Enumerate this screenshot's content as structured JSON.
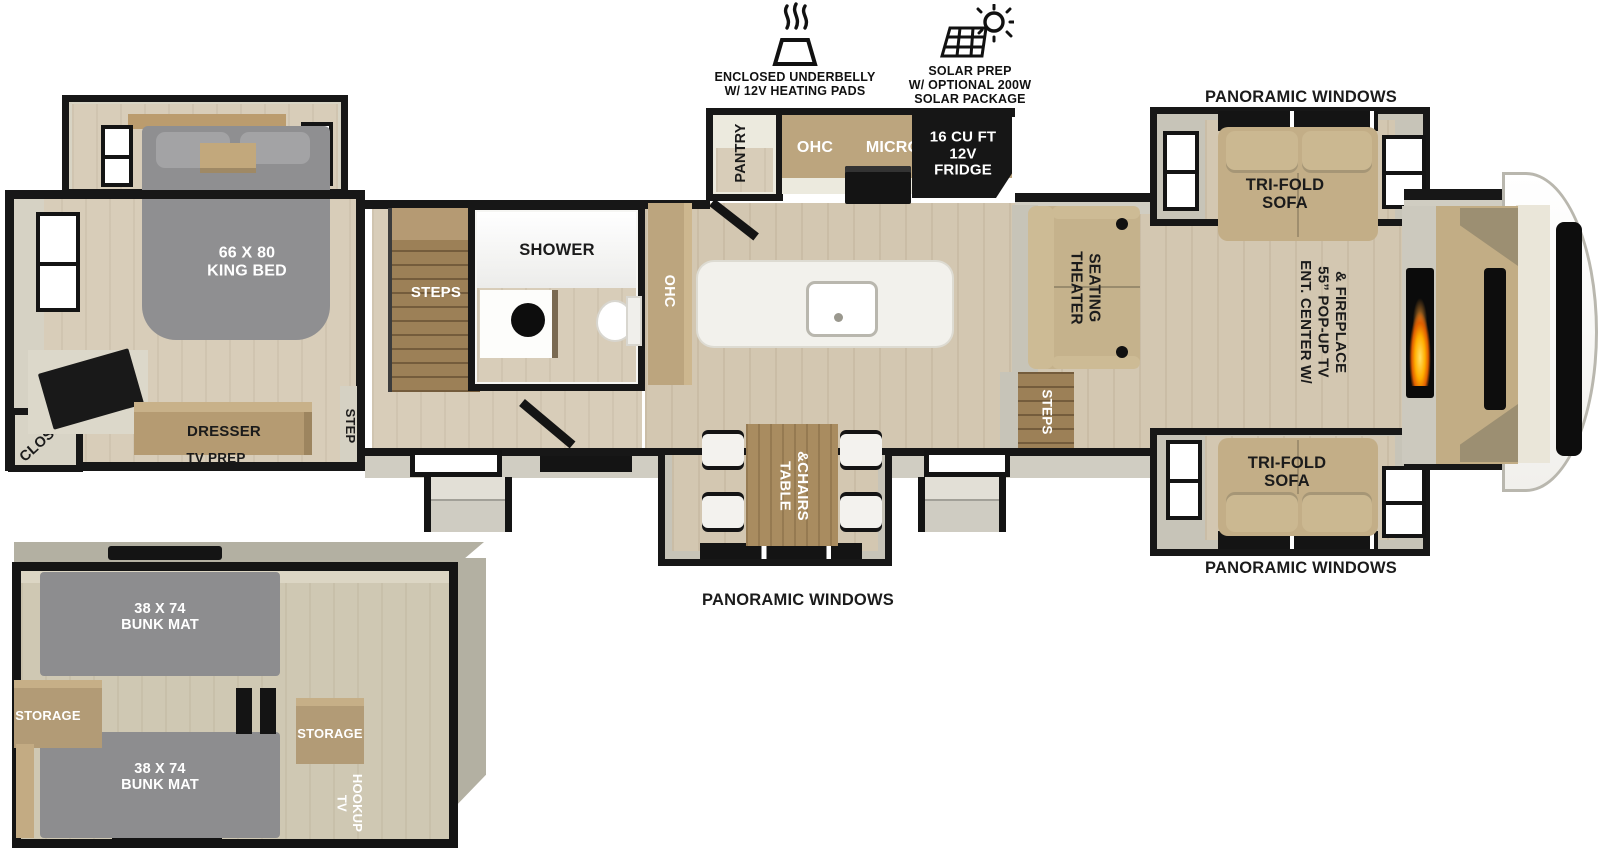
{
  "legend": {
    "underbelly": {
      "line1": "ENCLOSED UNDERBELLY",
      "line2": "W/ 12V HEATING PADS"
    },
    "solar": {
      "line1": "SOLAR PREP",
      "line2": "W/ OPTIONAL 200W",
      "line3": "SOLAR PACKAGE"
    }
  },
  "labels": {
    "panoramic_windows": "PANORAMIC WINDOWS",
    "pass_thru": {
      "line1": "XL TEXAS SIZE",
      "line2": "PASS THRU",
      "line3": "STORAGE"
    },
    "tri_fold_sofa": {
      "line1": "TRI-FOLD",
      "line2": "SOFA"
    },
    "ent_center": {
      "line1": "ENT. CENTER W/",
      "line2": "55” POP-UP TV",
      "line3": "& FIREPLACE"
    },
    "theater_seating": {
      "line1": "THEATER",
      "line2": "SEATING"
    },
    "steps": "STEPS",
    "step": "STEP",
    "fridge": {
      "line1": "16 CU FT",
      "line2": "12V",
      "line3": "FRIDGE"
    },
    "micro": "MICRO",
    "ohc": "OHC",
    "pantry": "PANTRY",
    "hutch": "HUTCH",
    "shower": "SHOWER",
    "king_bed": {
      "line1": "66 X 80",
      "line2": "KING BED"
    },
    "closet": "CLOSET",
    "dresser": "DRESSER",
    "tv_prep": "TV PREP",
    "table_chairs": {
      "line1": "TABLE",
      "line2": "&CHAIRS"
    }
  },
  "bunk_room": {
    "bunk_mat": {
      "line1": "38 X 74",
      "line2": "BUNK MAT"
    },
    "storage": "STORAGE",
    "tv_hookup": {
      "line1": "TV",
      "line2": "HOOKUP"
    }
  },
  "colors": {
    "arrow_blue": "#29abe2",
    "wall_black": "#171717",
    "floor_tan": "#d3c7b1",
    "furniture_tan": "#c3ae87",
    "mat_gray": "#8d8d8f",
    "flame_orange": "#ff9400"
  }
}
